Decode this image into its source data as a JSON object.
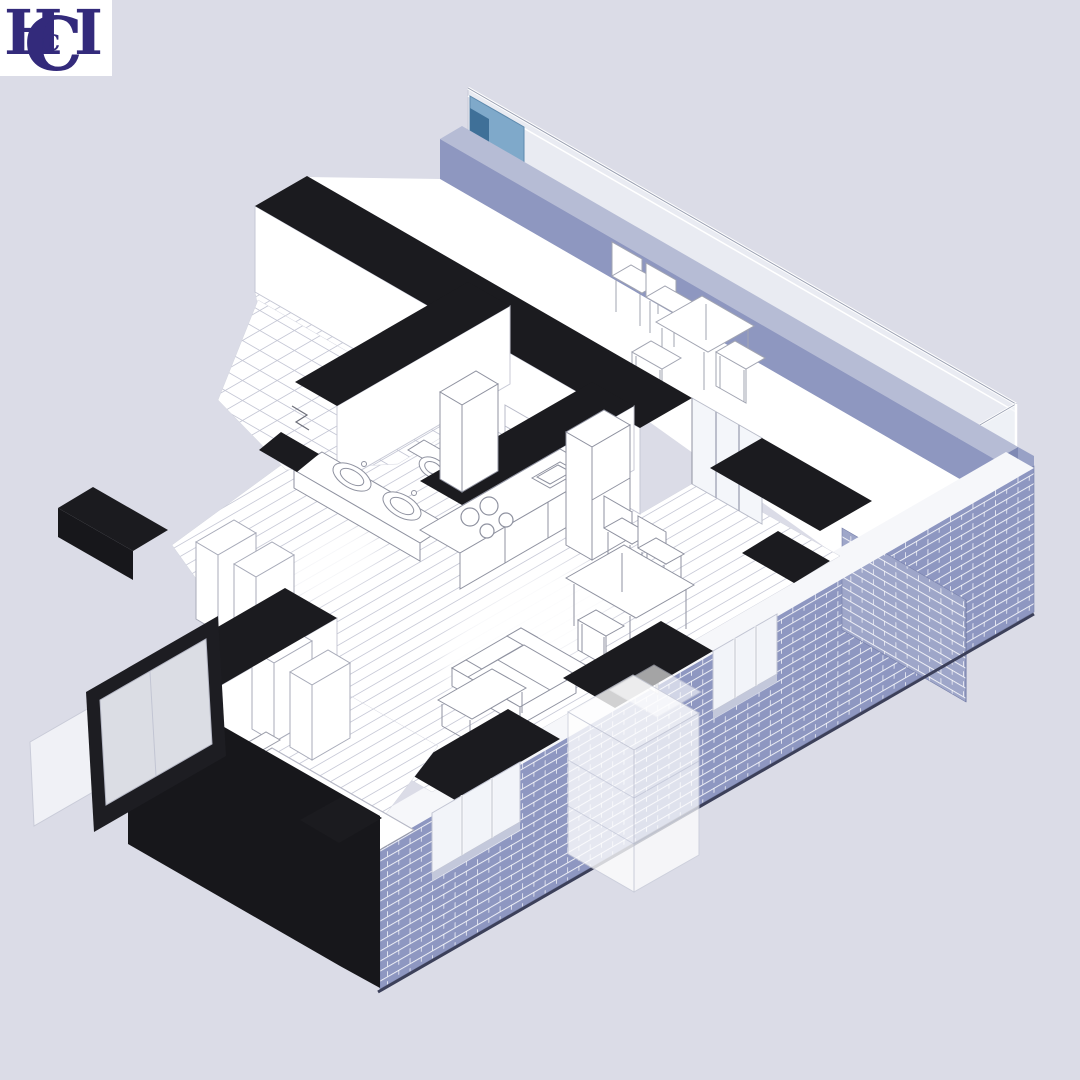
{
  "logo": {
    "letters": {
      "h": "H",
      "c_big": "C",
      "c_small": "c",
      "i": "I"
    },
    "color": "#332a7b",
    "background": "#ffffff"
  },
  "palette": {
    "background": "#dbdce7",
    "cut_wall_black": "#1b1b1f",
    "brick_periwinkle": "#8e97c1",
    "brick_light": "#9ea6c9",
    "parapet_band": "#8e97c0",
    "parapet_highlight": "#b6bcd5",
    "glass_blue": "#7fa9ca",
    "glass_blue_dark": "#3f7098",
    "furniture_line": "#8f92a0",
    "floor_line": "#c9cbd8",
    "white_surface": "#ffffff"
  },
  "scene": {
    "type": "axonometric-apartment-cutaway",
    "rooms": [
      {
        "name": "terrace",
        "features": [
          "glass-railing",
          "periwinkle-parapet",
          "outdoor-table",
          "outdoor-chairs"
        ]
      },
      {
        "name": "kitchen",
        "features": [
          "counter",
          "cooktop-4-burners",
          "sink",
          "tall-cabinets",
          "wall-cabinets"
        ]
      },
      {
        "name": "bathroom",
        "features": [
          "double-sink-vanity",
          "toilet",
          "tiled-floor"
        ]
      },
      {
        "name": "living-dining",
        "features": [
          "sofa",
          "coffee-table",
          "dining-table",
          "dining-chairs",
          "plank-floor"
        ]
      },
      {
        "name": "bedroom",
        "features": [
          "double-bed",
          "bench",
          "wardrobe",
          "leaning-window-pane"
        ]
      },
      {
        "name": "hall",
        "features": [
          "wardrobe-row",
          "entry-door"
        ]
      }
    ],
    "exterior": [
      "black-cut-wall-tops",
      "brick-facade-with-windows",
      "window-piers",
      "ghost-translucent-volume"
    ]
  }
}
